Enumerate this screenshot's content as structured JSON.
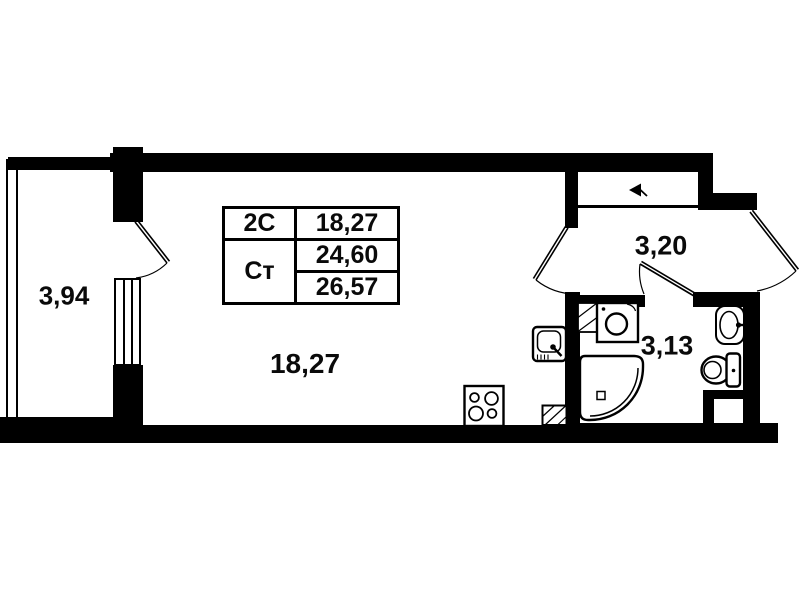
{
  "floorplan": {
    "rooms": {
      "balcony": {
        "area": "3,94"
      },
      "living_room": {
        "area": "18,27"
      },
      "hallway": {
        "area": "3,20"
      },
      "bathroom": {
        "area": "3,13"
      }
    },
    "area_table": {
      "row1": {
        "label": "2С",
        "value": "18,27"
      },
      "row2": {
        "label": "Ст",
        "value_top": "24,60",
        "value_bottom": "26,57"
      }
    },
    "icons": {
      "entrance_arrow": "left-pointing door-entry marker"
    },
    "colors": {
      "wall": "#000000",
      "background": "#ffffff"
    }
  }
}
